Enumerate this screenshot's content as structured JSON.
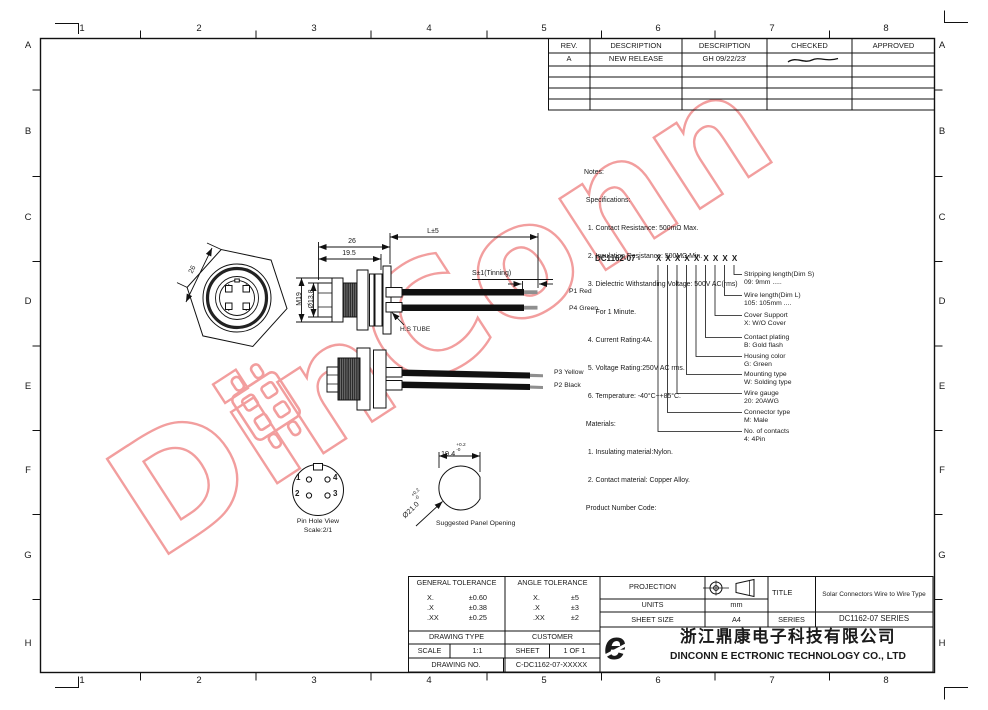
{
  "border": {
    "cols": [
      "1",
      "2",
      "3",
      "4",
      "5",
      "6",
      "7",
      "8"
    ],
    "rows": [
      "A",
      "B",
      "C",
      "D",
      "E",
      "F",
      "G",
      "H"
    ]
  },
  "rev_table": {
    "headers": [
      "REV.",
      "DESCRIPTION",
      "DESCRIPTION",
      "CHECKED",
      "APPROVED"
    ],
    "row": {
      "rev": "A",
      "description": "NEW RELEASE",
      "date": "GH 09/22/23'"
    }
  },
  "notes": {
    "lines": [
      "Notes:",
      " Specifications:",
      "  1. Contact Resistance: 500mΩ Max.",
      "  2. Insulation Resistance: 500MΩ Min.",
      "  3. Dielectric Withstanding Voltage: 500V AC(rms)",
      "      For 1 Minute.",
      "  4. Current Rating:4A.",
      "  5. Voltage Rating:250V AC rms.",
      "  6. Temperature: -40°C~+85°C.",
      " Materials:",
      "  1. Insulating material:Nylon.",
      "  2. Contact material: Copper Alloy.",
      " Product Number Code:"
    ]
  },
  "product_code": {
    "code": "DC1162-07 -",
    "placeholder": "X",
    "labels": [
      {
        "l1": "Stripping length(Dim S)",
        "l2": "09: 9mm ....."
      },
      {
        "l1": "Wire length(Dim L)",
        "l2": "105: 105mm ...."
      },
      {
        "l1": "Cover Support",
        "l2": "X: W/O Cover"
      },
      {
        "l1": "Contact plating",
        "l2": "B: Gold flash"
      },
      {
        "l1": "Housing color",
        "l2": "G: Green"
      },
      {
        "l1": "Mounting type",
        "l2": "W: Solding type"
      },
      {
        "l1": "Wire gauge",
        "l2": "20: 20AWG"
      },
      {
        "l1": "Connector type",
        "l2": "M: Male"
      },
      {
        "l1": "No. of contacts",
        "l2": "4: 4Pin"
      }
    ]
  },
  "dims": {
    "hex_width": "26",
    "len_26": "26",
    "len_19_5": "19.5",
    "wire_len": "L±5",
    "tinning": "S±1(Tinning)",
    "thread": "M19",
    "inner_dia": "Ø13.8",
    "hs_tube": "H.S TUBE"
  },
  "wires": {
    "p1": "P1 Red",
    "p4": "P4 Green",
    "p3": "P3 Yellow",
    "p2": "P2 Black"
  },
  "pin_view": {
    "pin1": "1",
    "pin2": "2",
    "pin3": "3",
    "pin4": "4",
    "caption1": "Pin Hole View",
    "caption2": "Scale:2/1"
  },
  "panel": {
    "width": "19.4",
    "width_plus": "+0.2",
    "width_minus": "-0",
    "dia": "Ø21.0",
    "dia_plus": "+0.2",
    "dia_minus": "-0",
    "caption": "Suggested Panel Opening"
  },
  "title_block": {
    "general_tolerance": {
      "header": "GENERAL TOLERANCE",
      "rows": [
        [
          "X.",
          "±0.60"
        ],
        [
          ".X",
          "±0.38"
        ],
        [
          ".XX",
          "±0.25"
        ]
      ]
    },
    "angle_tolerance": {
      "header": "ANGLE TOLERANCE",
      "rows": [
        [
          "X.",
          "±5"
        ],
        [
          ".X",
          "±3"
        ],
        [
          ".XX",
          "±2"
        ]
      ]
    },
    "drawing_type_label": "DRAWING TYPE",
    "customer_label": "CUSTOMER",
    "scale_label": "SCALE",
    "scale_value": "1:1",
    "sheet_label": "SHEET",
    "sheet_value": "1 OF 1",
    "drawing_no_label": "DRAWING NO.",
    "drawing_no_value": "C-DC1162-07-XXXXX",
    "projection_label": "PROJECTION",
    "units_label": "UNITS",
    "units_value": "mm",
    "sheet_size_label": "SHEET SIZE",
    "sheet_size_value": "A4",
    "title_label": "TITLE",
    "title_value": "Solar Connectors Wire to Wire Type",
    "series_label": "SERIES",
    "series_value": "DC1162-07 SERIES"
  },
  "company": {
    "logo_glyph": "e",
    "name_cn": "浙江鼎康电子科技有限公司",
    "name_en": "DINCONN E ECTRONIC TECHNOLOGY CO., LTD"
  },
  "watermark": {
    "text": "DinConn",
    "color": "#f29e9e"
  }
}
